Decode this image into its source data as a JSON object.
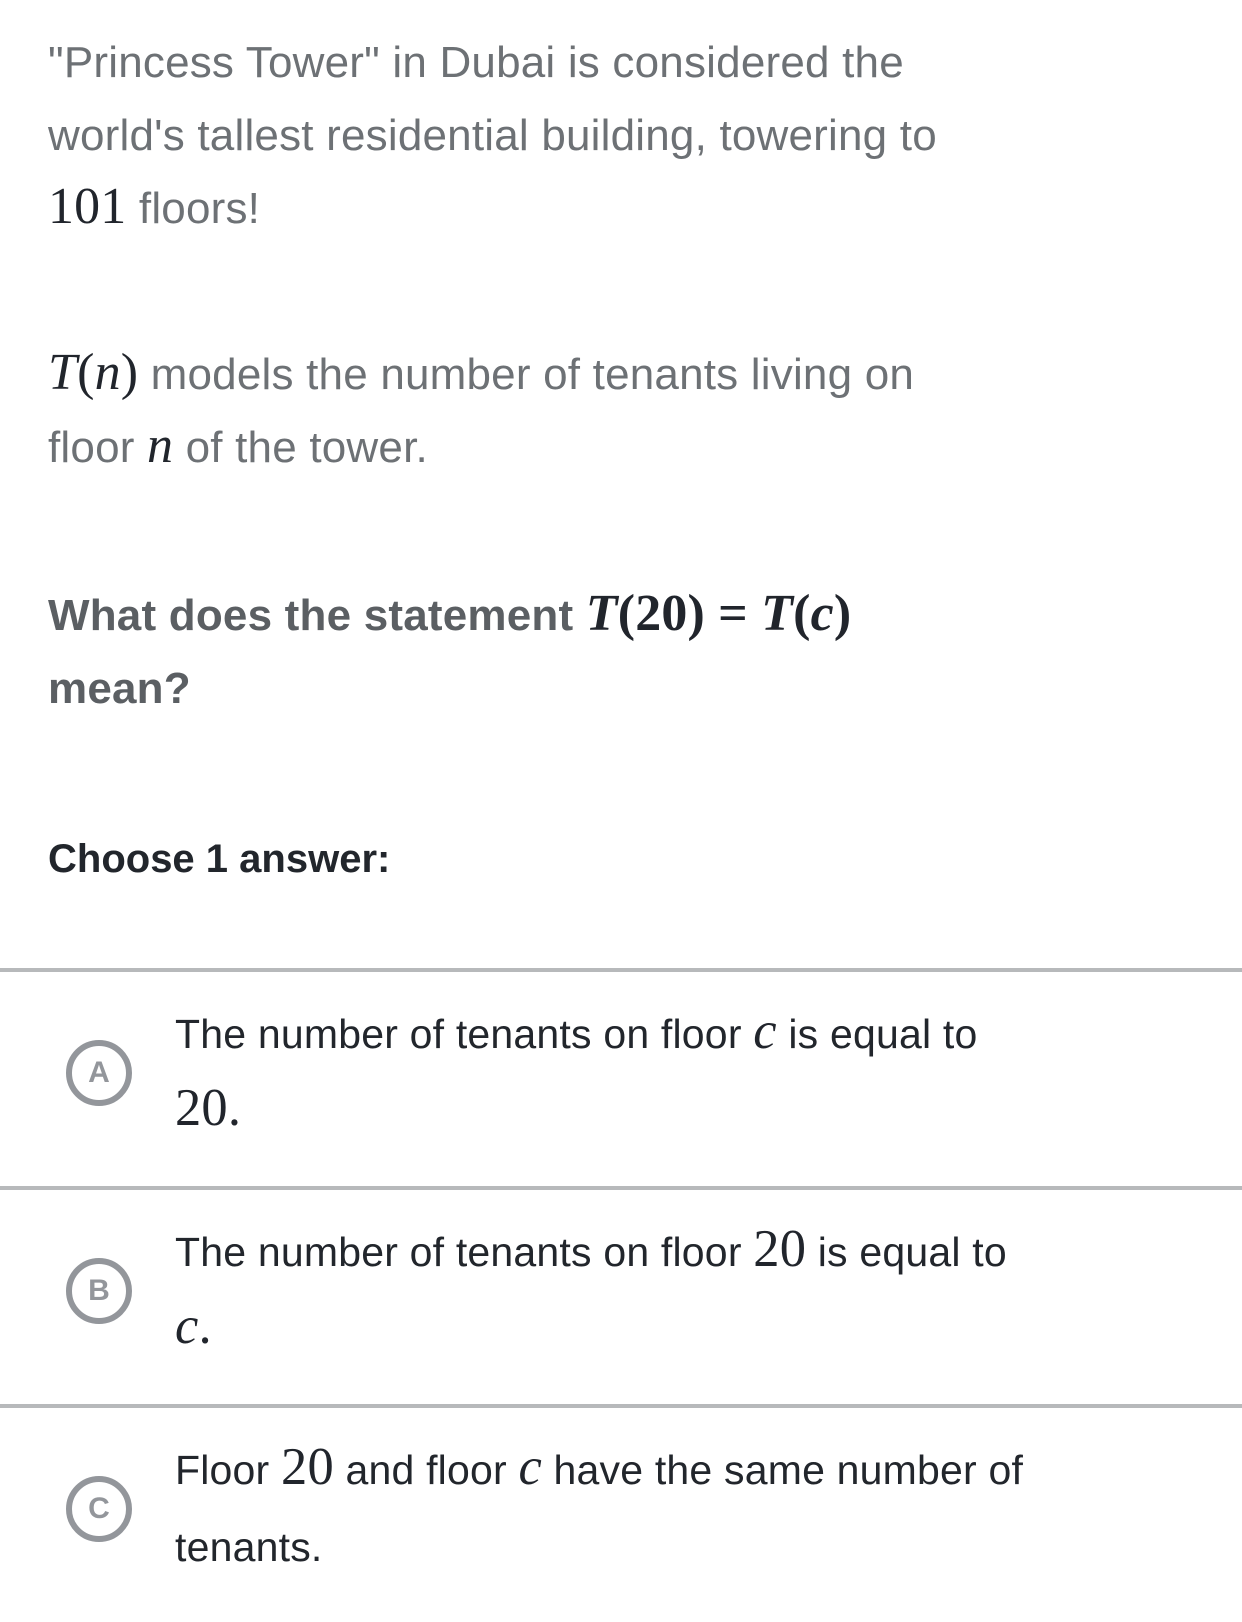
{
  "colors": {
    "text-gray": "#6d7175",
    "text-bold-gray": "#5b5f63",
    "text-dark": "#22262c",
    "math-dark": "#21252c",
    "ring-gray": "#93969b",
    "divider-gray": "#b7b9bb",
    "page-bg": "#ffffff"
  },
  "question": {
    "intro_segments": [
      {
        "t": "\"Princess Tower\" in Dubai is considered the",
        "n": "intro-line-1"
      },
      {
        "br": true
      },
      {
        "t": "world's tallest residential building, towering to",
        "n": "intro-line-2"
      },
      {
        "br": true
      },
      {
        "t": "101",
        "c": "mn",
        "n": "math-101"
      },
      {
        "t": " floors!",
        "n": "intro-line-3"
      }
    ],
    "model_segments": [
      {
        "t": "T",
        "c": "mi",
        "n": "math-T"
      },
      {
        "t": "(",
        "c": "mo",
        "n": "math-paren"
      },
      {
        "t": "n",
        "c": "mi",
        "n": "math-n"
      },
      {
        "t": ")",
        "c": "mo",
        "n": "math-paren"
      },
      {
        "t": " models the number of tenants living on",
        "n": "model-line-1"
      },
      {
        "br": true
      },
      {
        "t": "floor ",
        "n": "model-line-2a"
      },
      {
        "t": "n",
        "c": "mi",
        "n": "math-n"
      },
      {
        "t": " of the tower.",
        "n": "model-line-2b"
      }
    ],
    "prompt_segments": [
      {
        "t": "What does the statement ",
        "n": "prompt-line-1"
      },
      {
        "t": "T",
        "c": "mi",
        "n": "math-T"
      },
      {
        "t": "(",
        "c": "mo",
        "n": "math-paren"
      },
      {
        "t": "20",
        "c": "mn",
        "n": "math-20"
      },
      {
        "t": ")",
        "c": "mo",
        "n": "math-paren"
      },
      {
        "t": " = ",
        "c": "mo",
        "n": "math-equals"
      },
      {
        "t": "T",
        "c": "mi",
        "n": "math-T"
      },
      {
        "t": "(",
        "c": "mo",
        "n": "math-paren"
      },
      {
        "t": "c",
        "c": "mi",
        "n": "math-c"
      },
      {
        "t": ")",
        "c": "mo",
        "n": "math-paren"
      },
      {
        "br": true
      },
      {
        "t": "mean?",
        "n": "prompt-line-2"
      }
    ],
    "choose_label": "Choose 1 answer:"
  },
  "answers": [
    {
      "letter": "A",
      "segments": [
        {
          "t": "The number of tenants on floor ",
          "n": "answer-a-line-1a"
        },
        {
          "t": "c",
          "c": "mi",
          "n": "math-c"
        },
        {
          "t": " is equal to",
          "n": "answer-a-line-1b"
        },
        {
          "br": true
        },
        {
          "t": "20.",
          "c": "mn",
          "n": "math-20-period"
        }
      ]
    },
    {
      "letter": "B",
      "segments": [
        {
          "t": "The number of tenants on floor ",
          "n": "answer-b-line-1a"
        },
        {
          "t": "20",
          "c": "mn",
          "n": "math-20"
        },
        {
          "t": " is equal to",
          "n": "answer-b-line-1b"
        },
        {
          "br": true
        },
        {
          "t": "c",
          "c": "mi",
          "n": "math-c"
        },
        {
          "t": ".",
          "c": "mo",
          "n": "math-period"
        }
      ]
    },
    {
      "letter": "C",
      "segments": [
        {
          "t": "Floor ",
          "n": "answer-c-line-1a"
        },
        {
          "t": "20",
          "c": "mn",
          "n": "math-20"
        },
        {
          "t": " and floor ",
          "n": "answer-c-line-1b"
        },
        {
          "t": "c",
          "c": "mi",
          "n": "math-c"
        },
        {
          "t": " have the same number of",
          "n": "answer-c-line-1c"
        },
        {
          "br": true
        },
        {
          "t": "tenants.",
          "n": "answer-c-line-2"
        }
      ]
    }
  ]
}
